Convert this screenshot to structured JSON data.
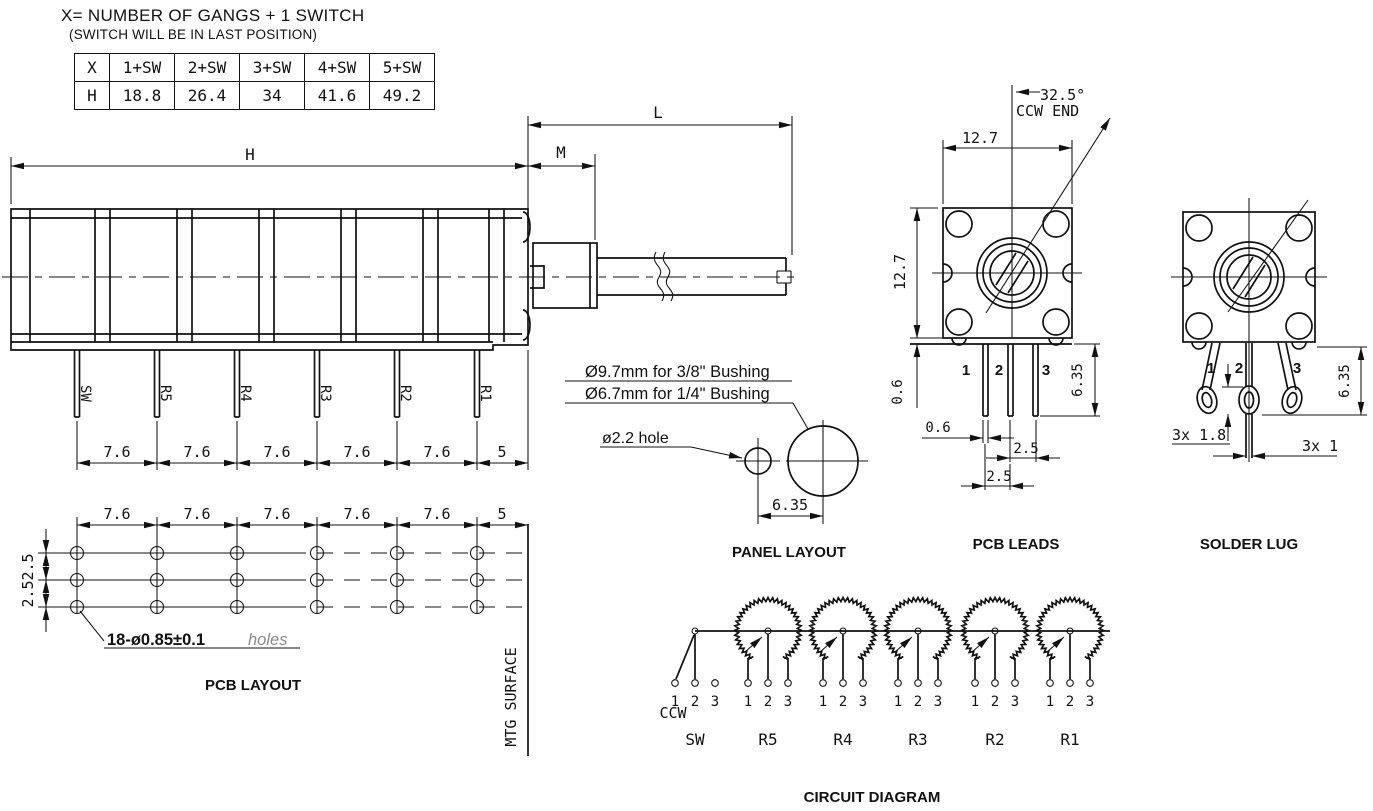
{
  "note": {
    "line1": "X= NUMBER OF GANGS + 1 SWITCH",
    "line2": "(SWITCH WILL BE IN LAST POSITION)"
  },
  "table": {
    "row1": [
      "X",
      "1+SW",
      "2+SW",
      "3+SW",
      "4+SW",
      "5+SW"
    ],
    "row2": [
      "H",
      "18.8",
      "26.4",
      "34",
      "41.6",
      "49.2"
    ]
  },
  "side_view": {
    "dim_h": "H",
    "dim_m": "M",
    "dim_l": "L",
    "leads": [
      "SW",
      "R5",
      "R4",
      "R3",
      "R2",
      "R1"
    ],
    "pitch": [
      "7.6",
      "7.6",
      "7.6",
      "7.6",
      "7.6",
      "5"
    ]
  },
  "pcb_layout": {
    "title": "PCB LAYOUT",
    "pitch": [
      "7.6",
      "7.6",
      "7.6",
      "7.6",
      "7.6",
      "5"
    ],
    "row_pitch": [
      "2.5",
      "2.5"
    ],
    "holes_note": "18-ø0.85±0.1",
    "holes_word": "holes",
    "mtg": "MTG  SURFACE"
  },
  "panel_layout": {
    "title": "PANEL LAYOUT",
    "note1": "Ø9.7mm for 3/8\" Bushing",
    "note2": "Ø6.7mm for 1/4\" Bushing",
    "hole_note": "ø2.2  hole",
    "dim": "6.35"
  },
  "pcb_leads": {
    "title": "PCB LEADS",
    "angle": "32.5°",
    "ccw_end": "CCW END",
    "dim_width": "12.7",
    "dim_height": "12.7",
    "dim_seat": "0.6",
    "dim_pin_width": "0.6",
    "dim_pin_length": "6.35",
    "dim_pitch_23": "2.5",
    "dim_pitch_12": "2.5",
    "pins": [
      "1",
      "2",
      "3"
    ]
  },
  "solder_lug": {
    "title": "SOLDER LUG",
    "pins": [
      "1",
      "2",
      "3"
    ],
    "dim_length": "6.35",
    "dim_hole": "3x  1.8",
    "dim_thickness": "3x  1"
  },
  "circuit": {
    "title": "CIRCUIT DIAGRAM",
    "ccw": "CCW",
    "units": [
      {
        "name": "SW",
        "pins": [
          "1",
          "2",
          "3"
        ]
      },
      {
        "name": "R5",
        "pins": [
          "1",
          "2",
          "3"
        ]
      },
      {
        "name": "R4",
        "pins": [
          "1",
          "2",
          "3"
        ]
      },
      {
        "name": "R3",
        "pins": [
          "1",
          "2",
          "3"
        ]
      },
      {
        "name": "R2",
        "pins": [
          "1",
          "2",
          "3"
        ]
      },
      {
        "name": "R1",
        "pins": [
          "1",
          "2",
          "3"
        ]
      }
    ]
  }
}
